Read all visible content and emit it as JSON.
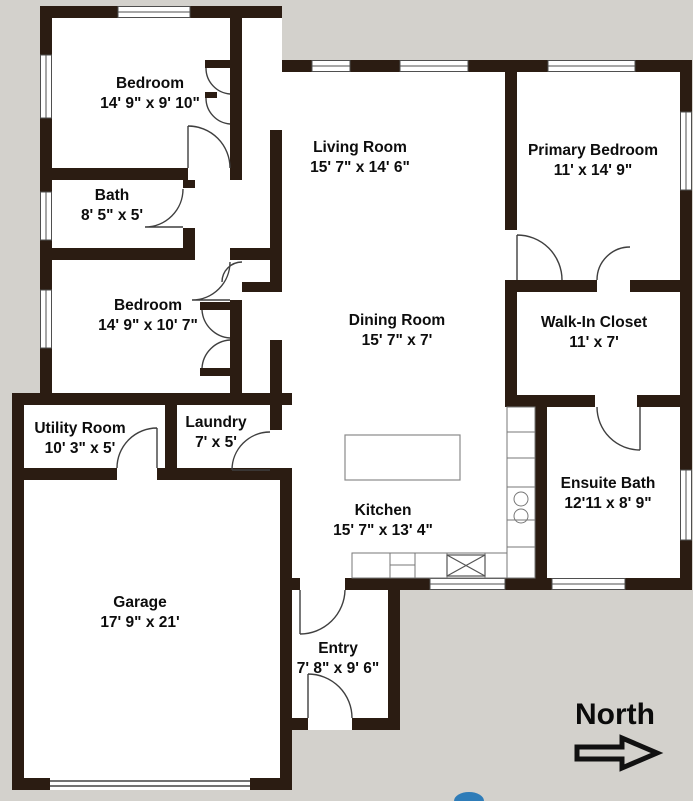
{
  "colors": {
    "background": "#d3d1cc",
    "walls": "#2b1c12",
    "room_fill": "#ffffff",
    "logo_accent": "#2e7cb8"
  },
  "compass": {
    "label": "North",
    "direction": "right"
  },
  "rooms": [
    {
      "name": "Bedroom",
      "dims": "14' 9\" x 9' 10\""
    },
    {
      "name": "Bath",
      "dims": "8' 5\" x 5'"
    },
    {
      "name": "Bedroom",
      "dims": "14' 9\" x 10' 7\""
    },
    {
      "name": "Living Room",
      "dims": "15' 7\" x 14' 6\""
    },
    {
      "name": "Primary Bedroom",
      "dims": "11' x 14' 9\""
    },
    {
      "name": "Walk-In Closet",
      "dims": "11' x 7'"
    },
    {
      "name": "Dining Room",
      "dims": "15' 7\" x 7'"
    },
    {
      "name": "Utility Room",
      "dims": "10' 3\" x 5'"
    },
    {
      "name": "Laundry",
      "dims": "7' x 5'"
    },
    {
      "name": "Kitchen",
      "dims": "15' 7\" x 13' 4\""
    },
    {
      "name": "Ensuite Bath",
      "dims": "12'11 x 8' 9\""
    },
    {
      "name": "Garage",
      "dims": "17' 9\" x 21'"
    },
    {
      "name": "Entry",
      "dims": "7' 8\" x 9' 6\""
    }
  ],
  "fixtures": [
    "kitchen-island",
    "kitchen-counter",
    "kitchen-sink",
    "stove",
    "garage-door",
    "front-door",
    "interior-doors",
    "windows"
  ]
}
